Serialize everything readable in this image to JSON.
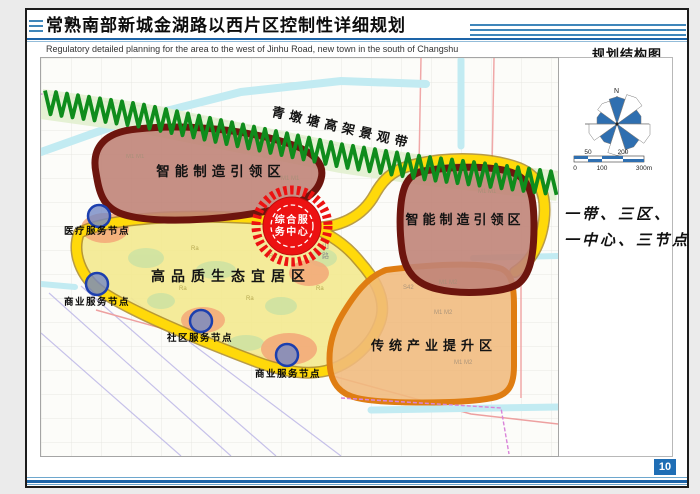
{
  "header": {
    "title": "常熟南部新城金湖路以西片区控制性详细规划",
    "subtitle": "Regulatory detailed planning for the area to the west of Jinhu Road, new town in the south of Changshu"
  },
  "side_panel": {
    "title": "规划结构图",
    "compass_north": "N",
    "scale_labels_above": [
      "50",
      "200"
    ],
    "scale_labels_below": [
      "0",
      "100",
      "300m"
    ],
    "summary_line1": "一带、三区、",
    "summary_line2": "一中心、三节点"
  },
  "map": {
    "belt_label": "青墩塘高架景观带",
    "zones": [
      {
        "id": "smart-manufacturing-west",
        "label": "智能制造引领区"
      },
      {
        "id": "smart-manufacturing-east",
        "label": "智能制造引领区"
      },
      {
        "id": "eco-living",
        "label": "高品质生态宜居区"
      },
      {
        "id": "traditional-industry",
        "label": "传统产业提升区"
      }
    ],
    "center_badge": {
      "line1": "综合服",
      "line2": "务中心"
    },
    "nodes": [
      {
        "label": "医疗服务节点"
      },
      {
        "label": "商业服务节点"
      },
      {
        "label": "社区服务节点"
      },
      {
        "label": "商业服务节点"
      }
    ],
    "road_label_chars": [
      "山",
      "路"
    ],
    "background_labels": [
      "M1  M1",
      "M1  M1",
      "M1  M1",
      "Ra",
      "Ra",
      "Ra",
      "Ra",
      "Ra",
      "S42",
      "M1  M2",
      "M1  M2",
      "M1  M2"
    ]
  },
  "footer": {
    "page_number": "10"
  },
  "colors": {
    "accent_blue": "#1d64a8",
    "belt_green": "#0f8c1c",
    "zone_maroon_border": "#6d150e",
    "zone_maroon_fill": "#c08478",
    "road_yellow": "#ffd90a",
    "eco_fill": "#f3e98f",
    "industry_border": "#df7d12",
    "industry_fill": "#f0b97c",
    "badge_red": "#ec1212",
    "node_fill": "#7488c4",
    "node_border": "#1c3fae",
    "compass_blue": "#2f6fb0",
    "page_number_bg": "#1f6eb5"
  }
}
